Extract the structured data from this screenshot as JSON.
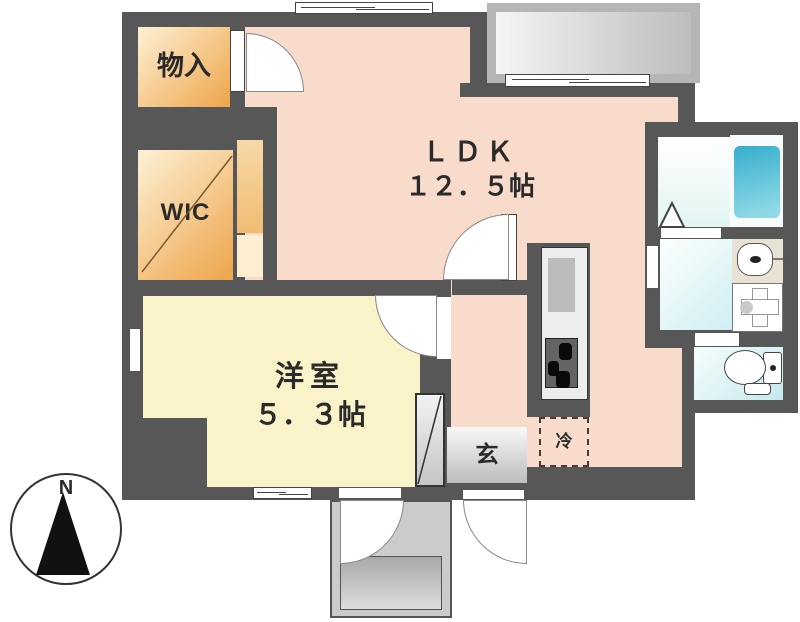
{
  "title": "apartment-floor-plan",
  "labels": {
    "ldk_name": "ＬＤＫ",
    "ldk_size": "１２．５帖",
    "western_name": "洋室",
    "western_size": "５．３帖",
    "wic": "WIC",
    "storage": "物入",
    "entrance": "玄",
    "refrigerator": "冷",
    "compass_n": "N"
  },
  "colors": {
    "wall": "#575757",
    "ldk_floor": "#f9dbcb",
    "storage_light": "#fdedcf",
    "storage_deep": "#eea850",
    "western_floor": "#faf3c9",
    "genkan_light": "#f8f8f8",
    "genkan_dark": "#bdbdbd",
    "fridge_dash": "#4a3a3a",
    "tub_top": "#35aecd",
    "tub_bottom": "#8fd9e6",
    "water_light": "#fdffff",
    "water_deep": "#cfeef1"
  }
}
